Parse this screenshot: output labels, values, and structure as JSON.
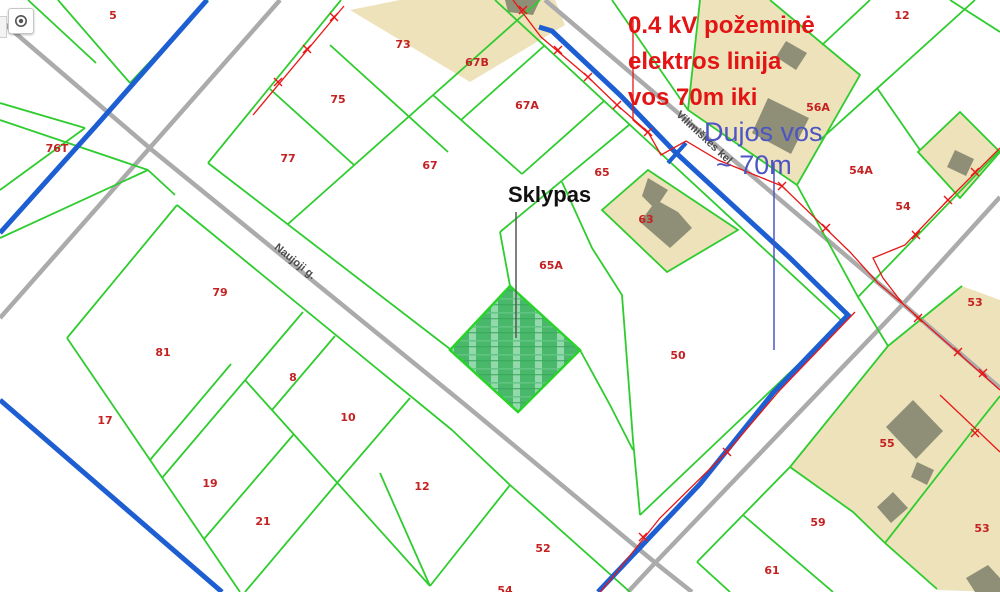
{
  "map": {
    "parcel_labels": [
      {
        "id": "5",
        "x": 113,
        "y": 15
      },
      {
        "id": "76T",
        "x": 57,
        "y": 148
      },
      {
        "id": "73",
        "x": 403,
        "y": 44
      },
      {
        "id": "67B",
        "x": 477,
        "y": 62
      },
      {
        "id": "75",
        "x": 338,
        "y": 99
      },
      {
        "id": "67A",
        "x": 527,
        "y": 105
      },
      {
        "id": "77",
        "x": 288,
        "y": 158
      },
      {
        "id": "67",
        "x": 430,
        "y": 165
      },
      {
        "id": "65",
        "x": 602,
        "y": 172
      },
      {
        "id": "63",
        "x": 646,
        "y": 219
      },
      {
        "id": "56A",
        "x": 818,
        "y": 107
      },
      {
        "id": "12",
        "x": 902,
        "y": 15
      },
      {
        "id": "54A",
        "x": 861,
        "y": 170
      },
      {
        "id": "54",
        "x": 903,
        "y": 206
      },
      {
        "id": "53",
        "x": 975,
        "y": 302
      },
      {
        "id": "65A",
        "x": 551,
        "y": 265
      },
      {
        "id": "50",
        "x": 678,
        "y": 355
      },
      {
        "id": "79",
        "x": 220,
        "y": 292
      },
      {
        "id": "81",
        "x": 163,
        "y": 352
      },
      {
        "id": "8",
        "x": 293,
        "y": 377
      },
      {
        "id": "17",
        "x": 105,
        "y": 420
      },
      {
        "id": "10",
        "x": 348,
        "y": 417
      },
      {
        "id": "19",
        "x": 210,
        "y": 483
      },
      {
        "id": "12",
        "x": 422,
        "y": 486
      },
      {
        "id": "21",
        "x": 263,
        "y": 521
      },
      {
        "id": "52",
        "x": 543,
        "y": 548
      },
      {
        "id": "55",
        "x": 887,
        "y": 443
      },
      {
        "id": "59",
        "x": 818,
        "y": 522
      },
      {
        "id": "61",
        "x": 772,
        "y": 570
      },
      {
        "id": "53",
        "x": 982,
        "y": 528
      },
      {
        "id": "54",
        "x": 505,
        "y": 590
      }
    ],
    "street_labels": [
      {
        "name": "Naujoji g.",
        "x": 293,
        "y": 264,
        "angle": 39
      },
      {
        "name": "Vilimiškės kel.",
        "x": 703,
        "y": 141,
        "angle": 43
      }
    ],
    "annotations": {
      "sklypas": {
        "text": "Sklypas"
      },
      "electric": {
        "lines": [
          "0.4 kV požeminė",
          "elektros linija",
          "vos 70m iki"
        ],
        "color": "#e31414"
      },
      "gas": {
        "lines": [
          "Dujos vos",
          "~ 70m"
        ],
        "color": "#4d55c4"
      }
    },
    "colors": {
      "parcel_line": "#2ecc2e",
      "road": "#ababab",
      "gas_line": "#1d5fd2",
      "electric_line": "#e81717",
      "building": "#8f8f78",
      "built_area": "#eee2ba",
      "highlight_parcel": "#4ab86a"
    },
    "controls": {
      "locate_button": "locate"
    }
  }
}
